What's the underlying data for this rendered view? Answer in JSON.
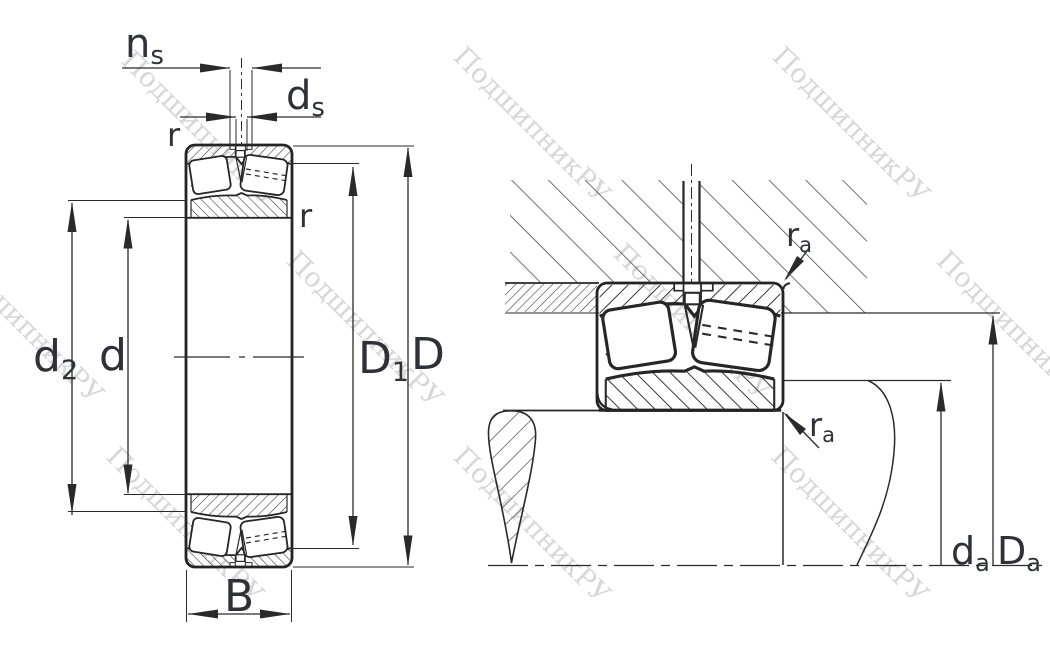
{
  "watermark": {
    "text": "ПодшипникРУ"
  },
  "left_view": {
    "labels": {
      "ns_base": "n",
      "ns_sub": "s",
      "ds_base": "d",
      "ds_sub": "s",
      "r_top": "r",
      "r_side": "r",
      "d2_base": "d",
      "d2_sub": "2",
      "d": "d",
      "D1_base": "D",
      "D1_sub": "1",
      "D": "D",
      "B": "B"
    }
  },
  "right_view": {
    "labels": {
      "ra_top_base": "r",
      "ra_top_sub": "a",
      "ra_bottom_base": "r",
      "ra_bottom_sub": "a",
      "da_base": "d",
      "da_sub": "a",
      "Da_base": "D",
      "Da_sub": "a"
    }
  },
  "colors": {
    "line": "#262626",
    "label": "#2e3138",
    "watermark": "#d7d7d7",
    "hatch_fine": "#2e2e2e",
    "hatch_coarse": "#565656"
  }
}
